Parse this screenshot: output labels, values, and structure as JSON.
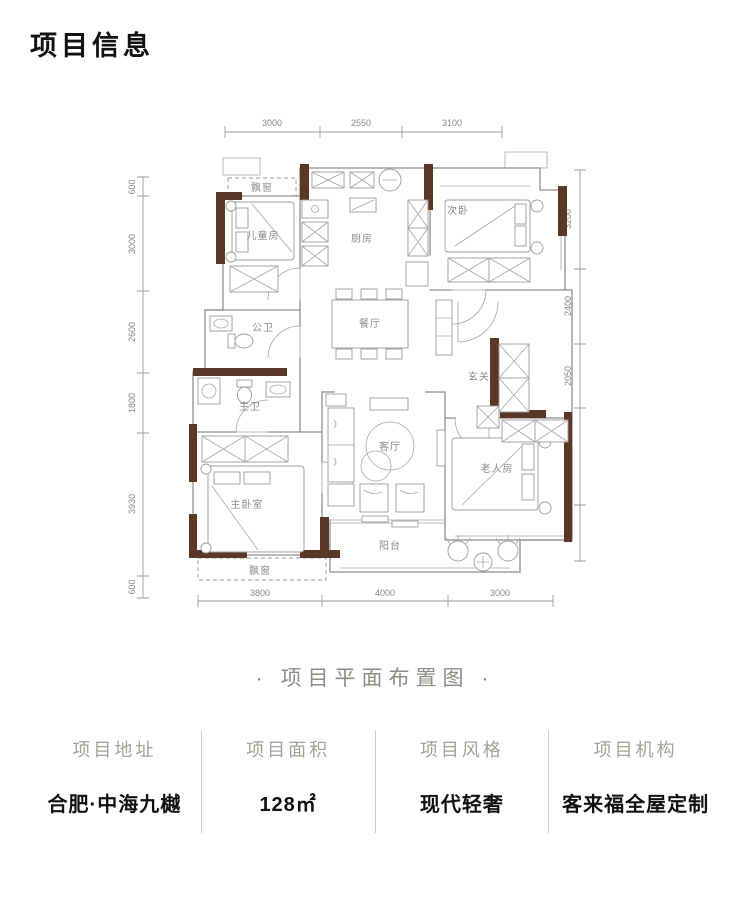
{
  "page": {
    "title": "项目信息"
  },
  "plan": {
    "caption": "· 项目平面布置图 ·",
    "dims": {
      "top": [
        "3000",
        "2550",
        "3100"
      ],
      "bottom": [
        "3800",
        "4000",
        "3000"
      ],
      "left": [
        "600",
        "3000",
        "2600",
        "1800",
        "3930",
        "600"
      ],
      "right": [
        "3200",
        "2400",
        "2050",
        "3150",
        "1800"
      ]
    },
    "rooms": {
      "children_room": "儿童房",
      "kitchen": "厨房",
      "second_bedroom": "次卧",
      "public_bath": "公卫",
      "dining": "餐厅",
      "entry": "玄关",
      "master_bath": "主卫",
      "living": "客厅",
      "elder_room": "老人房",
      "master_bedroom": "主卧室",
      "balcony": "阳台",
      "bay_window_top": "飘窗",
      "bay_window_bottom": "飘窗"
    },
    "colors": {
      "wall_fill": "#5b3728",
      "line": "#8e8e8e",
      "dim_text": "#868686"
    }
  },
  "info": {
    "items": [
      {
        "label": "项目地址",
        "value": "合肥·中海九樾"
      },
      {
        "label": "项目面积",
        "value": "128㎡"
      },
      {
        "label": "项目风格",
        "value": "现代轻奢"
      },
      {
        "label": "项目机构",
        "value": "客来福全屋定制"
      }
    ]
  }
}
